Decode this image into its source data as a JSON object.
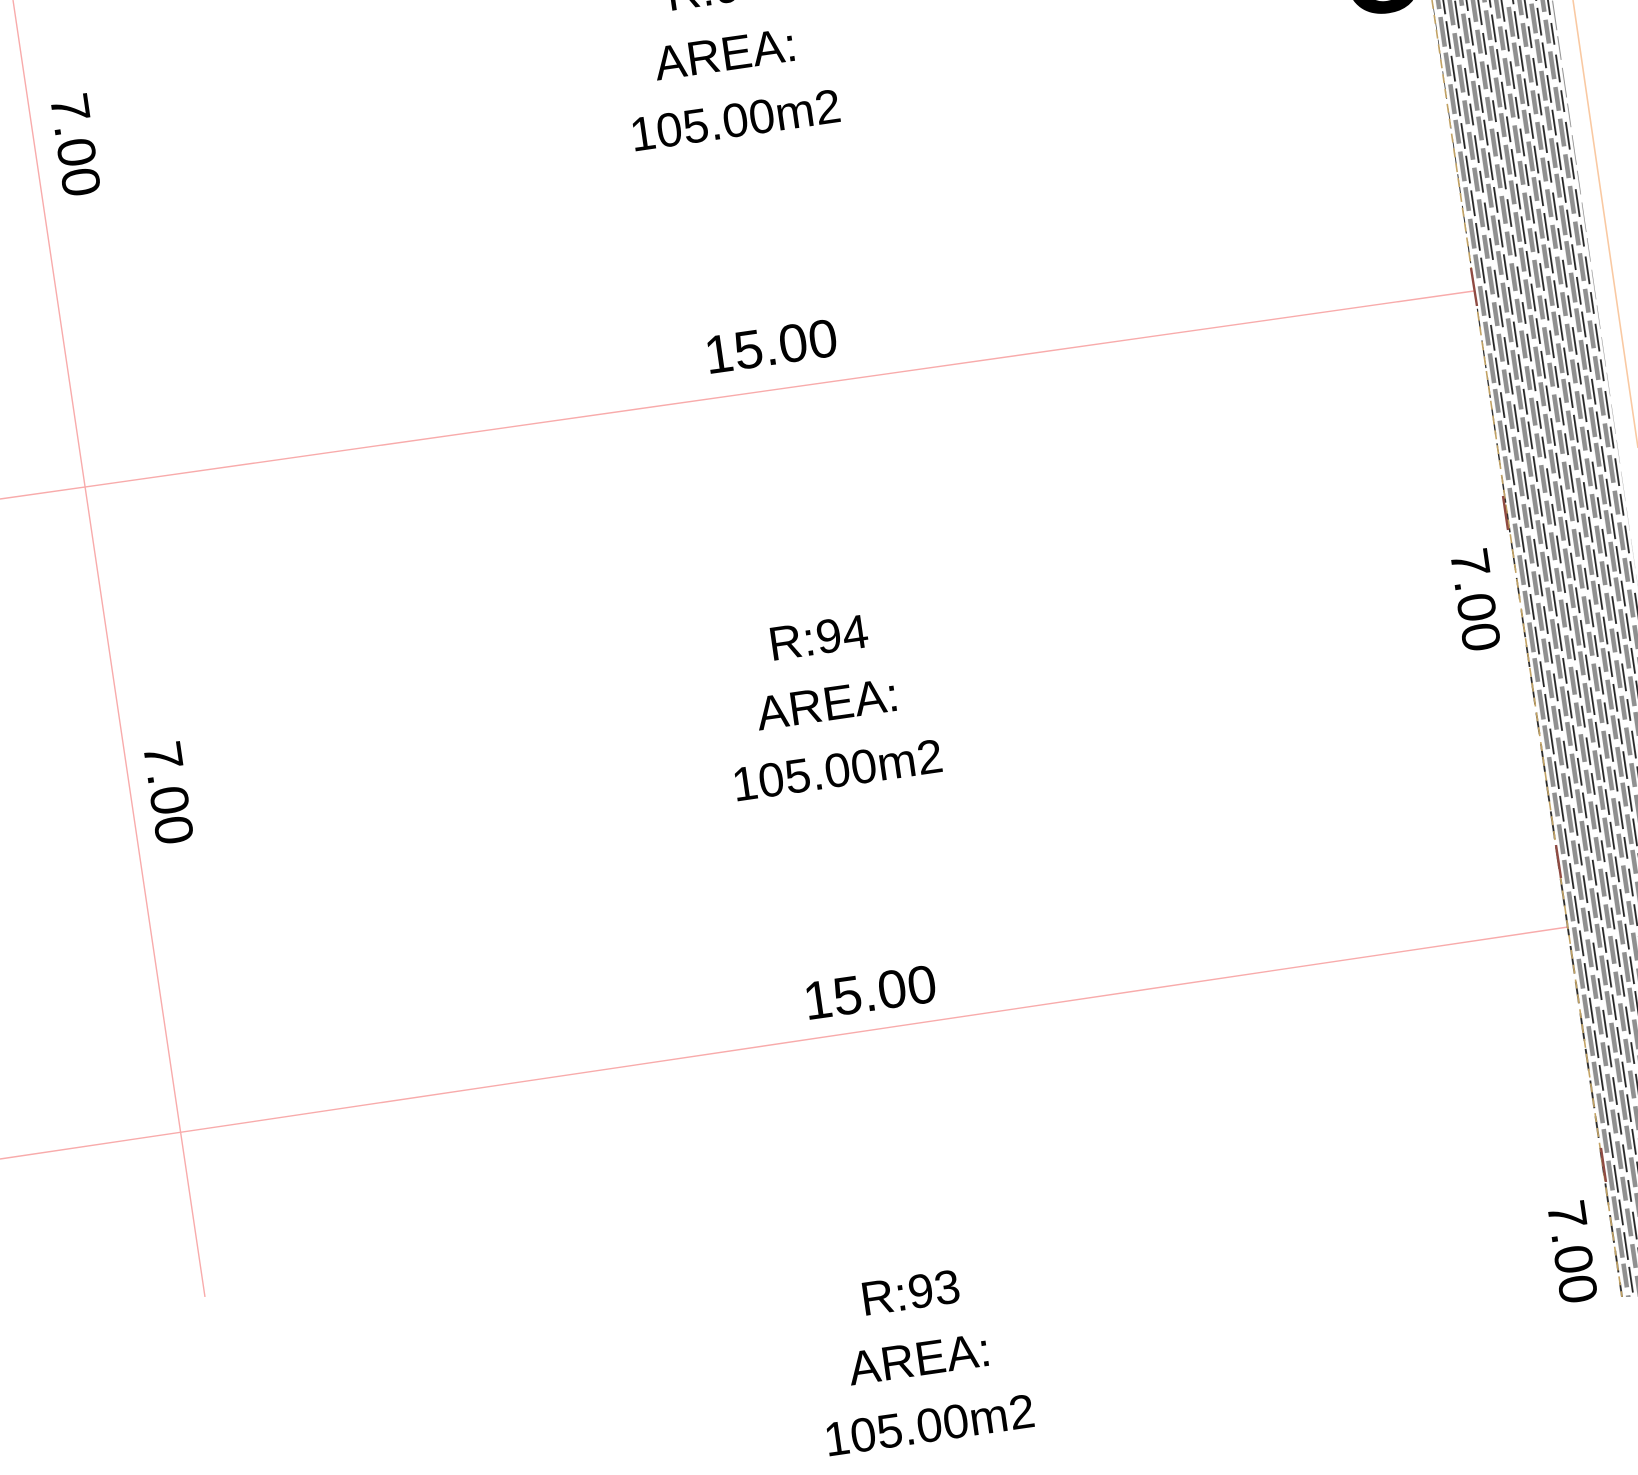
{
  "drawing_type": "cadastral parcel plan (CAD viewer canvas)",
  "parcels": [
    {
      "name": "R:95",
      "area_label": "AREA:",
      "area_value": "105.00m2"
    },
    {
      "name": "R:94",
      "area_label": "AREA:",
      "area_value": "105.00m2"
    },
    {
      "name": "R:93",
      "area_label": "AREA:",
      "area_value": "105.00m2"
    }
  ],
  "dims": {
    "top_width": "15.00",
    "bottom_width": "15.00",
    "left_upper_depth": "7.00",
    "left_lower_depth": "7.00",
    "right_upper_depth": "7.00",
    "right_lower_depth": "7.00"
  },
  "clipped_letter": "C",
  "colors": {
    "boundary_pink": "#f8abab",
    "road_outer_peach": "#f9c9a2",
    "hatch_edge_tan": "#c2a263",
    "hatch_edge_darkred": "#8f4a42",
    "hatch_gray": "#909090",
    "hatch_black": "#222222",
    "text": "#000000"
  }
}
